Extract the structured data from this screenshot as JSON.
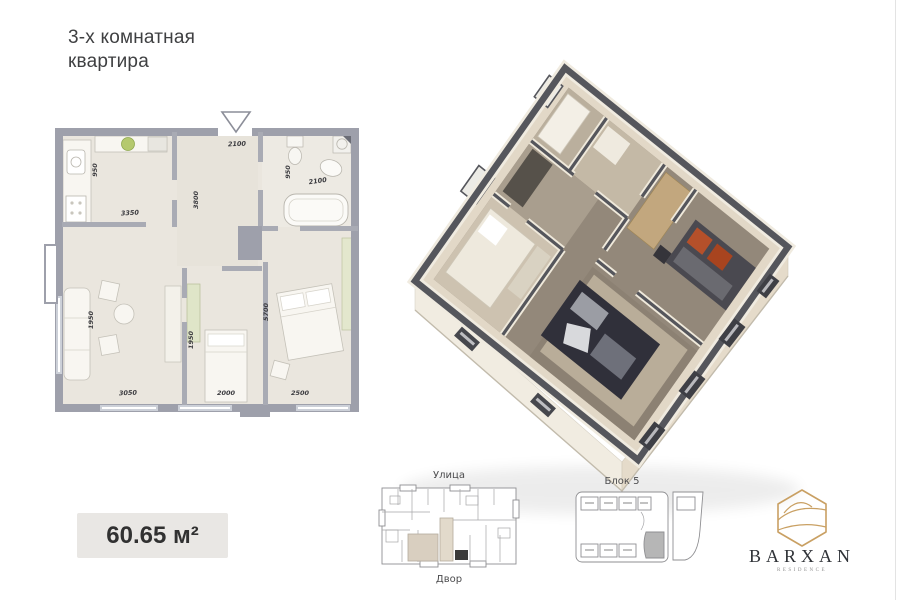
{
  "title": {
    "line1": "3-х комнатная",
    "line2": "квартира"
  },
  "area_badge": {
    "value": "60.65 м²"
  },
  "plan2d": {
    "dims": {
      "entry_top": "2100",
      "kitchen_width": "950",
      "kitchen_length": "3350",
      "hall_depth": "3800",
      "bath_width": "950",
      "bath_length": "2100",
      "living_width": "1950",
      "bedroom2_width": "1950",
      "bedroom1_length": "5700",
      "living_length": "3050",
      "bedroom2_length": "2000",
      "bedroom1_width": "2500"
    }
  },
  "site_plan": {
    "street_label": "Улица",
    "yard_label": "Двор"
  },
  "block_plan": {
    "title": "Блок 5"
  },
  "logo": {
    "brand": "BARXAN",
    "tagline": "RESIDENCE"
  },
  "colors": {
    "logo_gold": "#c9a063",
    "wall_gray": "#9ea0ab",
    "floor_beige": "#eae6de",
    "wall_top_dark": "#55565c",
    "floor3d_brown": "#93887a",
    "accent_orange": "#b5502a",
    "highlight_gray": "#b6b6b6"
  }
}
